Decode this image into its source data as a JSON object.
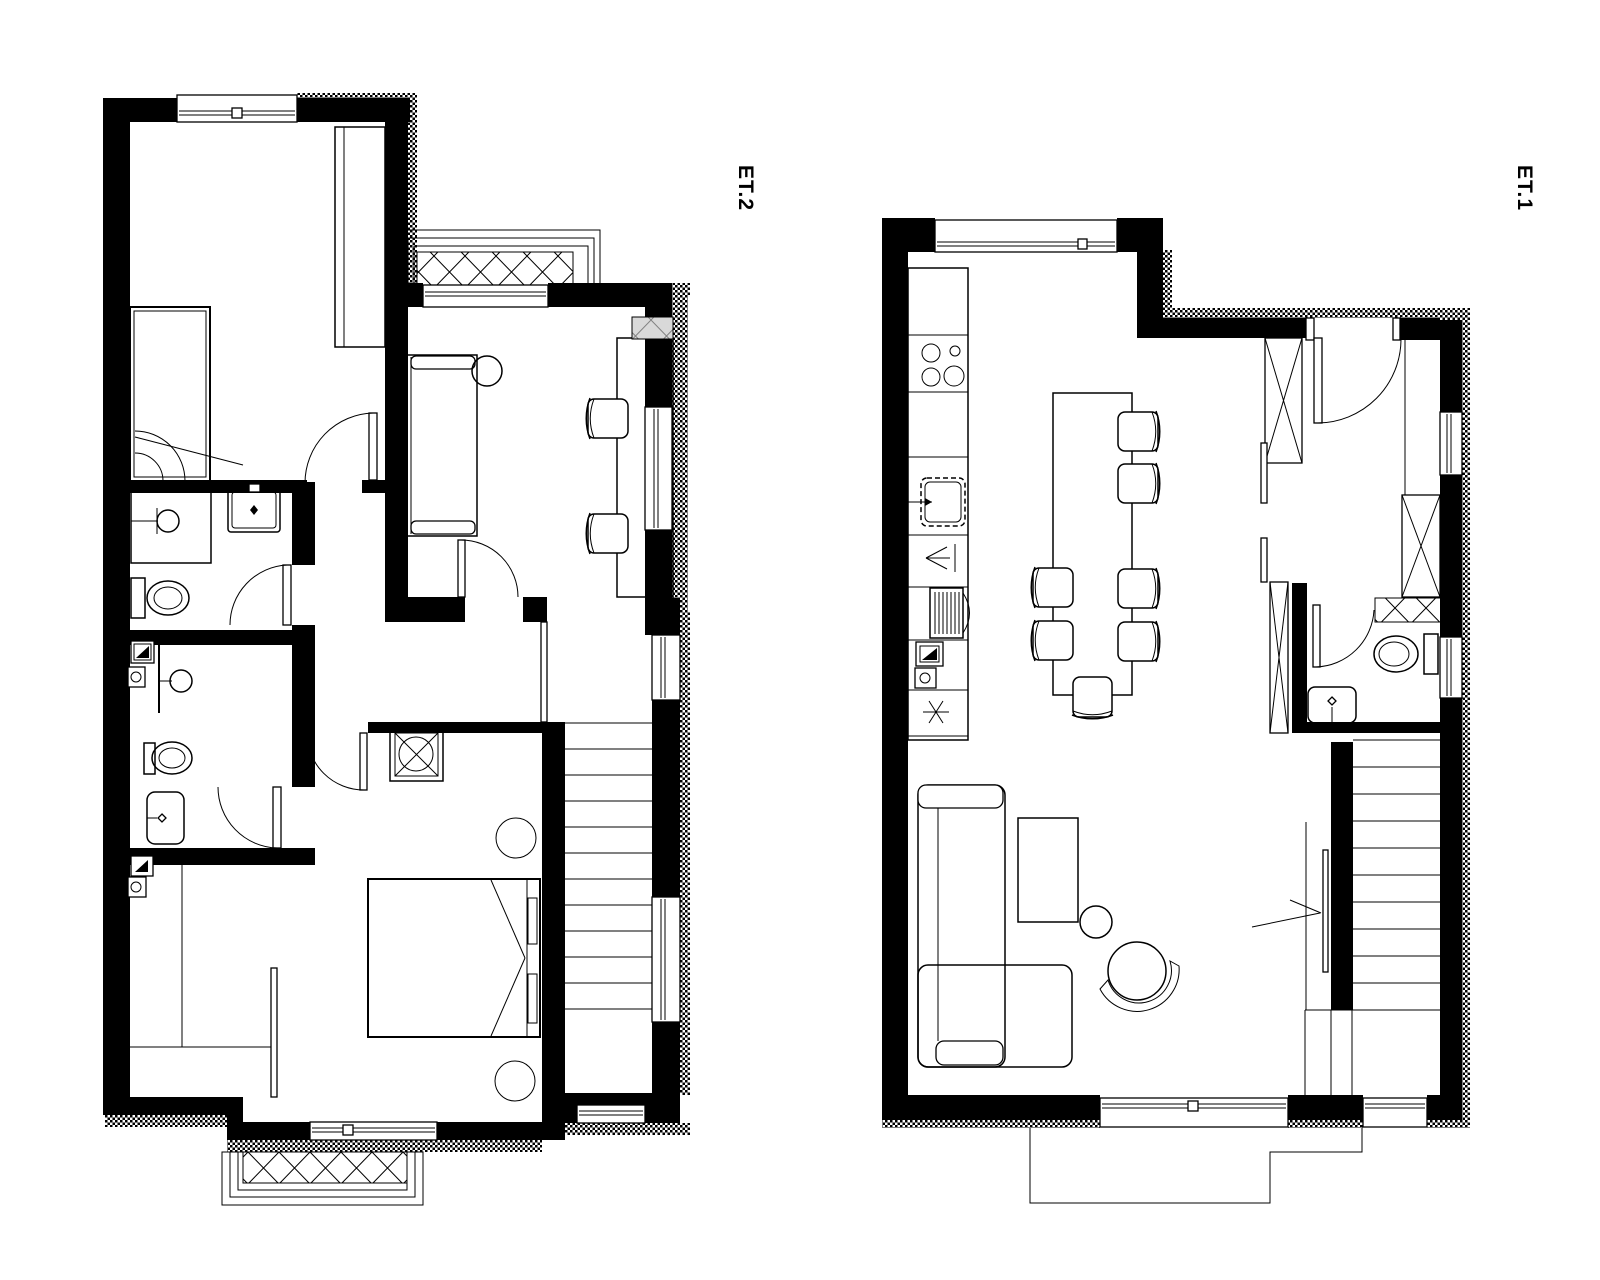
{
  "page": {
    "background": "#ffffff",
    "line_color": "#000000",
    "wall_color": "#000000",
    "shaft_gray": "#d9d9d9"
  },
  "plans": [
    {
      "label": "ET.2",
      "name": "upper-floor",
      "rooms": [
        "bedroom",
        "study",
        "hallway",
        "bathroom-upper",
        "bathroom-lower",
        "master-bedroom",
        "stairwell"
      ],
      "outdoor": [
        "north-balcony",
        "south-balcony"
      ],
      "fixtures": [
        "single-bed",
        "wardrobe",
        "sofa",
        "round-side-table",
        "desk",
        "desk-chairs",
        "grey-duct",
        "shower",
        "washbasin",
        "toilet",
        "shower-2",
        "washbasin-2",
        "toilet-2",
        "electrical-panels",
        "chimney-duct",
        "double-bed",
        "nightstands",
        "built-in-closet",
        "staircase"
      ]
    },
    {
      "label": "ET.1",
      "name": "ground-floor",
      "rooms": [
        "kitchen",
        "dining-area",
        "living-room",
        "entry-hall",
        "wc",
        "stairwell"
      ],
      "outdoor": [
        "terrace"
      ],
      "fixtures": [
        "kitchen-counter",
        "cooktop",
        "kitchen-sink",
        "dishwasher",
        "fridge",
        "freezer",
        "electrical-panel",
        "dining-table",
        "dining-chairs",
        "corner-sofa",
        "coffee-table",
        "round-side-table",
        "armchair",
        "entry-wardrobes",
        "toilet",
        "washbasin",
        "duct",
        "staircase",
        "entrance-door"
      ]
    }
  ]
}
